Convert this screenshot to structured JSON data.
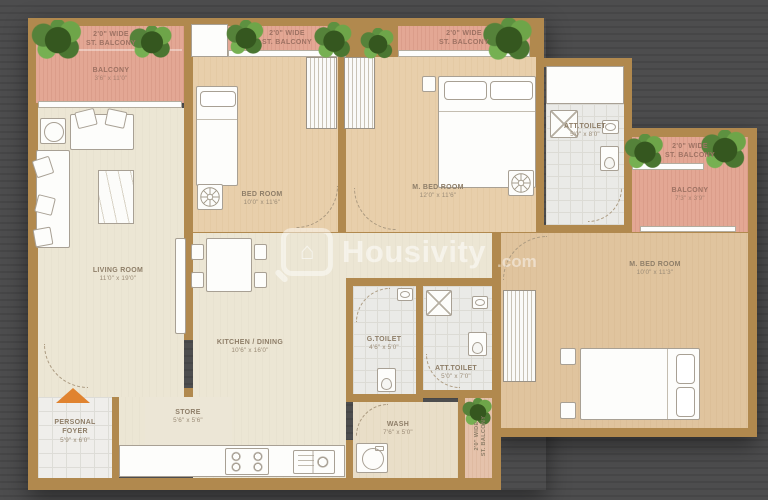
{
  "watermark": {
    "brand": "Housivity",
    "suffix": ".com"
  },
  "rooms": {
    "st_balcony_1": {
      "line1": "2'0\" WIDE",
      "line2": "ST. BALCONY"
    },
    "st_balcony_2": {
      "line1": "2'0\" WIDE",
      "line2": "ST. BALCONY"
    },
    "st_balcony_3": {
      "line1": "2'0\" WIDE",
      "line2": "ST. BALCONY"
    },
    "st_balcony_4": {
      "line1": "2'0\" WIDE",
      "line2": "ST. BALCONY"
    },
    "st_balcony_5": {
      "line1": "2'0\" WIDE",
      "line2": "ST. BALCONY"
    },
    "balcony_left": {
      "name": "BALCONY",
      "dims": "3'6\" x 11'0\""
    },
    "balcony_east": {
      "name": "BALCONY",
      "dims": "7'3\" x 3'9\""
    },
    "living_room": {
      "name": "LIVING ROOM",
      "dims": "11'0\" x 19'0\""
    },
    "bed_room": {
      "name": "BED ROOM",
      "dims": "10'0\" x 11'6\""
    },
    "m_bed_room_1": {
      "name": "M. BED ROOM",
      "dims": "12'0\" x 11'6\""
    },
    "m_bed_room_2": {
      "name": "M. BED ROOM",
      "dims": "10'0\" x 11'3\""
    },
    "att_toilet_1": {
      "name": "ATT.TOILET",
      "dims": "5'0\" x 8'0\""
    },
    "att_toilet_2": {
      "name": "ATT.TOILET",
      "dims": "5'0\" x 7'0\""
    },
    "g_toilet": {
      "name": "G.TOILET",
      "dims": "4'6\" x 5'0\""
    },
    "kitchen": {
      "name": "KITCHEN / DINING",
      "dims": "10'6\" x 16'0\""
    },
    "wash": {
      "name": "WASH",
      "dims": "7'6\" x 5'0\""
    },
    "store": {
      "name": "STORE",
      "dims": "5'6\" x 5'6\""
    },
    "personal_foyer": {
      "name": "PERSONAL FOYER",
      "dims": "5'9\" x 6'0\""
    }
  },
  "colors": {
    "wall": "#b1894e",
    "balcony_floor": "#e3a794",
    "bedroom_floor": "#e8cfab",
    "living_floor": "#ece6d4",
    "background": "#4a4a4b",
    "entry_arrow": "#e0832f",
    "plant": "#5d8f3d",
    "watermark": "#ffffff"
  }
}
